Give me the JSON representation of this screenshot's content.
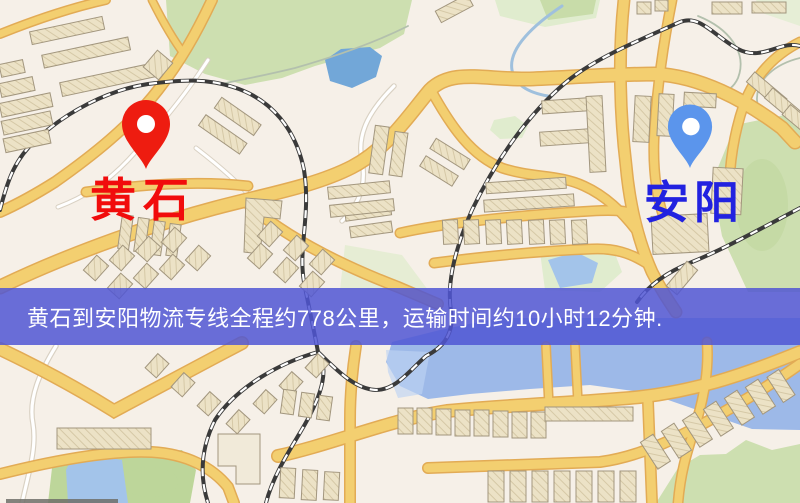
{
  "map": {
    "markers": {
      "origin": {
        "name": "黄石"
      },
      "destination": {
        "name": "安阳"
      }
    },
    "banner": {
      "text": "黄石到安阳物流专线全程约778公里，运输时间约10小时12分钟."
    },
    "route": {
      "origin": "黄石",
      "destination": "安阳",
      "distance": "约778公里",
      "duration": "约10小时12分钟"
    },
    "palette": {
      "background": "#f6f0e8",
      "road_major": "#f3cf70",
      "road_casing": "#e2ab55",
      "road_minor": "#ffffff",
      "road_minor_casing": "#d9d1c3",
      "park": "#cddfb0",
      "park_dark": "#bdd69a",
      "park_pale": "#e0ecce",
      "water": "#9db9e8",
      "water_light": "#bdd3f2",
      "lake": "#72a7d8",
      "pond": "#a3c4ea",
      "stream": "#9fc0dd",
      "contour": "#b3c0ad",
      "building_fill": "#ece2c6",
      "building_hatch": "#d5c8a6",
      "building_stroke": "#a2967e",
      "building_light": "#f1ead9",
      "railway": "#3a3a3a",
      "railway_dash": "#ffffff",
      "origin_pin": "#ee1c10",
      "origin_label_color": "#f10c0c",
      "destination_pin": "#5b95ec",
      "destination_label_color": "#2222e0",
      "banner_bg": "rgba(80,86,212,0.85)",
      "banner_fg": "#ffffff",
      "edge_strip": "#6f6f68"
    }
  }
}
